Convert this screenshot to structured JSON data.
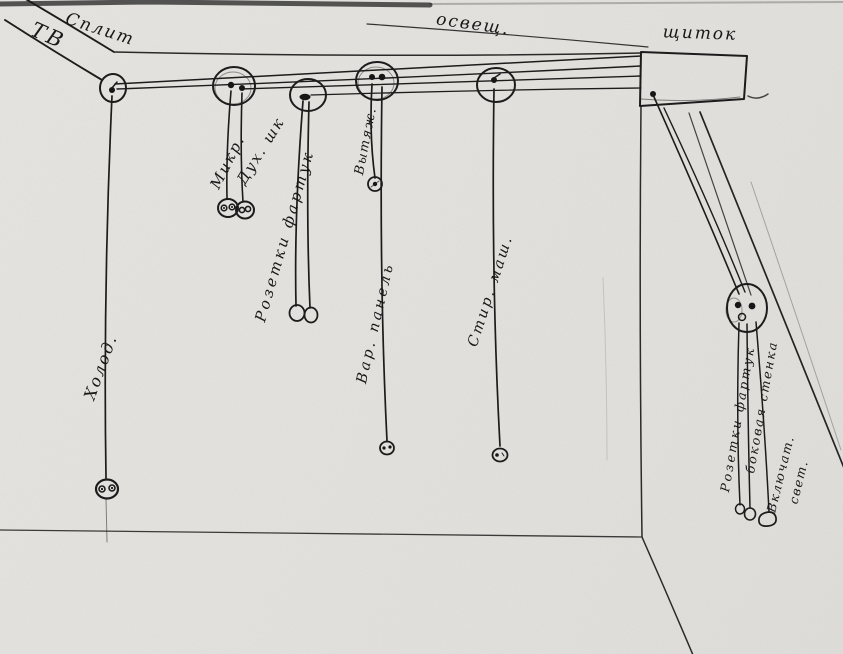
{
  "title": "Hand-drawn kitchen electrical wiring sketch",
  "labels": {
    "tv": "ТВ",
    "split": "Сплит",
    "lighting": "освещ.",
    "panel": "щиток",
    "microwave": "Микр.",
    "oven": "Дух. шк",
    "apron_outlets_left": "Розетки фартук",
    "hood": "Вытяж.",
    "cooktop": "Вар. панель",
    "washer": "Стир. маш.",
    "fridge": "Холод.",
    "apron_outlets_right": "Розетки фартук",
    "side_wall": "боковая стенка",
    "light_switch_line1": "Включат.",
    "light_switch_line2": "свет."
  },
  "colors": {
    "paper": "#e8e7e3",
    "ink": "#1c1c1c",
    "pencil": "#555550"
  }
}
